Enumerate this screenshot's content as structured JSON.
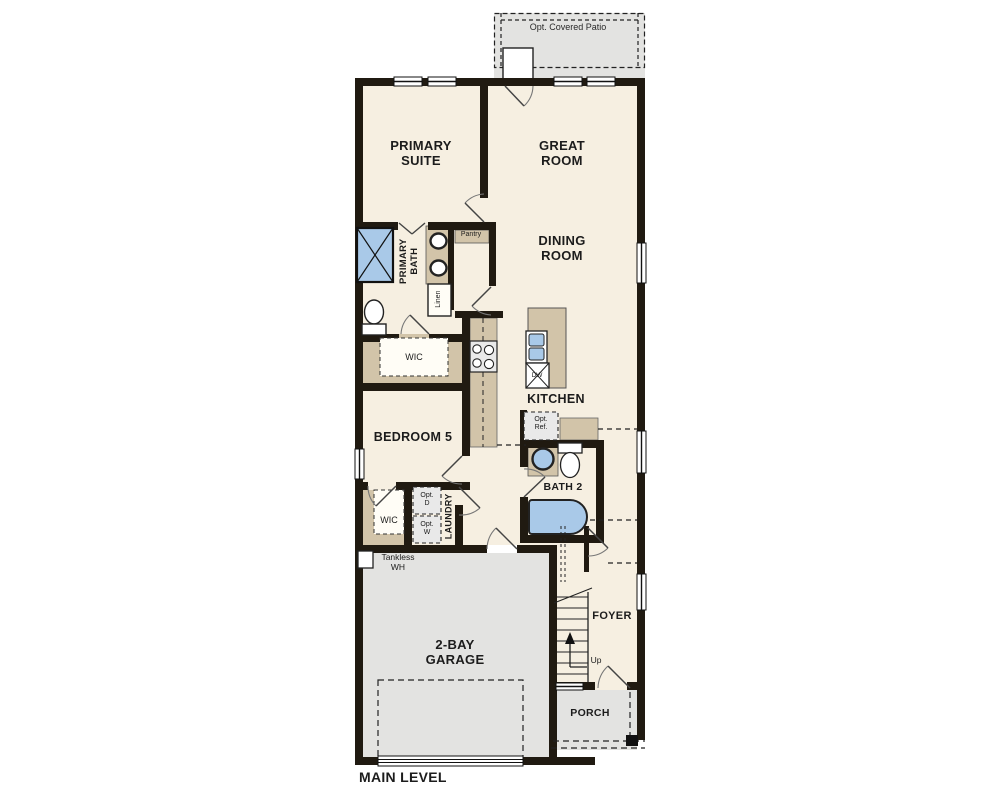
{
  "plan_title": "MAIN LEVEL",
  "labels": {
    "patio": "Opt. Covered Patio",
    "primary_suite": "PRIMARY SUITE",
    "great_room": "GREAT ROOM",
    "dining_room": "DINING ROOM",
    "primary_bath": "PRIMARY BATH",
    "pantry": "Pantry",
    "linen": "Linen",
    "wic_primary": "WIC",
    "kitchen": "KITCHEN",
    "dishwasher": "DW",
    "opt_ref": "Opt. Ref.",
    "bedroom5": "BEDROOM 5",
    "bath2": "BATH 2",
    "wic_bedroom5": "WIC",
    "laundry": "LAUNDRY",
    "opt_dryer": "Opt. D",
    "opt_washer": "Opt. W",
    "tankless": "Tankless WH",
    "garage": "2-BAY GARAGE",
    "foyer": "FOYER",
    "stairs_up": "Up",
    "porch": "PORCH"
  },
  "colors": {
    "interior_floor": "#f6efe1",
    "outdoor_floor": "#e3e3e1",
    "wall": "#201a11",
    "cabinet_tan": "#d2c4a9",
    "fixture_blue": "#a9c9e8",
    "appliance_gray": "#e9e9e9",
    "line": "#222222"
  }
}
